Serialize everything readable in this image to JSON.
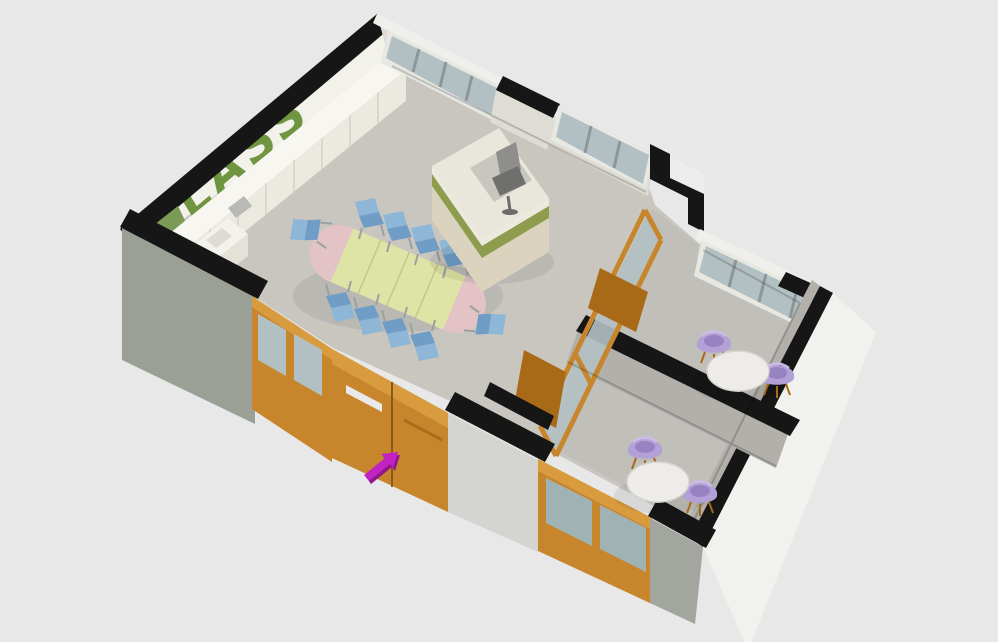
{
  "scene": {
    "wall_label": "CLASS",
    "type": "3d-isometric-floor-plan-render",
    "rooms": [
      "classroom-main",
      "meeting-room-upper",
      "meeting-room-lower"
    ],
    "furniture": {
      "conference_table_seats": 10,
      "meeting_room_upper_seats": 2,
      "meeting_room_lower_seats": 2,
      "reception_desk_seats": 1
    }
  },
  "colors": {
    "bg": "#e8e8e8",
    "black": "#161616",
    "floor": "#c9c6c0",
    "wall-int-white": "#f2f1ea",
    "wall-ne-int": "#dedcd5",
    "wall-gray-ext": "#9aa096",
    "wall-light-ext": "#d4d4d1",
    "wall-gray2-ext": "#a2a69e",
    "wall-se-ext": "#f1f1ed",
    "wall-int-gray": "#b3b0ab",
    "sliver-white": "#efefeb",
    "glass": "#b2c0c3",
    "glass-dark": "#9fb2b4",
    "frame-white": "#e8e8e3",
    "mullion": "#8d979a",
    "wood": "#c8862c",
    "wood-light": "#d89b3d",
    "wood-dark": "#a86a16",
    "label-green": "#6f9540",
    "green-floor": "#7a9a55",
    "cab-top": "#f7f6f1",
    "cab-front": "#ebe9e0",
    "desk-top": "#e9e7dc",
    "desk-panel": "#dbd3bd",
    "desk-green": "#8d9d4d",
    "table-yellow": "#dee3a6",
    "table-pink": "#e3c3c5",
    "chair-blue": "#8db6d7",
    "chair-blue-dark": "#6f9dc6",
    "chair-purple": "#b3a0d6",
    "chair-purple-dark": "#9782c2",
    "round-table": "#edece8",
    "metal": "#9aa0a2",
    "chair-gray": "#8e8e8c",
    "arrow": "#c322c3",
    "arrow-dark": "#8e1790"
  }
}
